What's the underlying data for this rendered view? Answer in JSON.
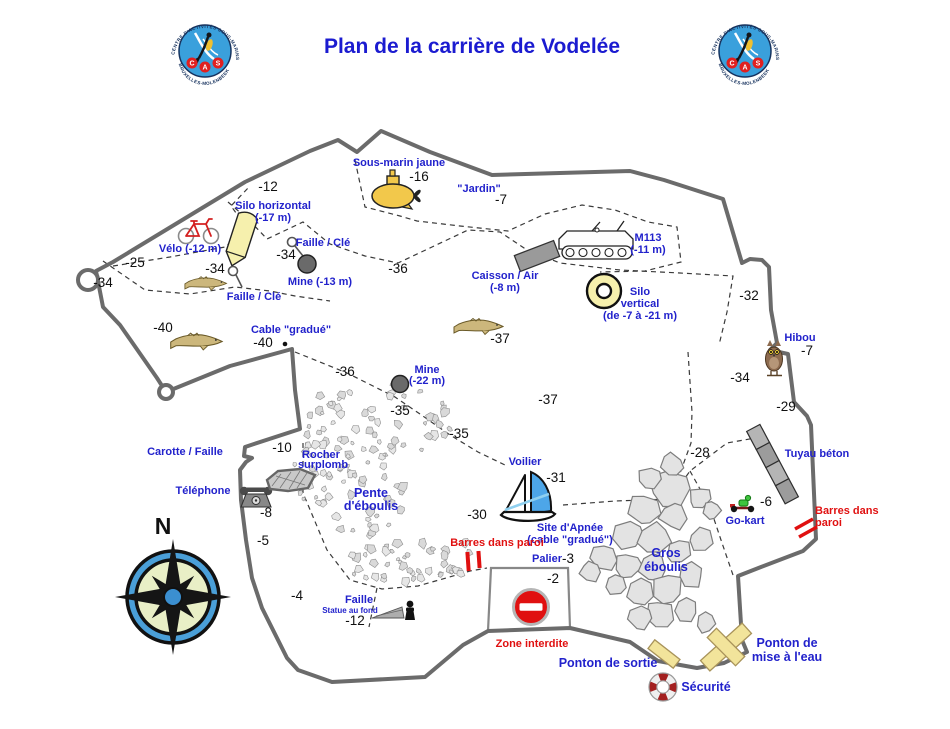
{
  "title": "Plan de la carrière de Vodelée",
  "logo": {
    "arc_top": "CENTRE D'ACTIVITÉS SOUS-MARINS",
    "arc_bottom": "BRUXELLES-MOLENBEEK",
    "letters": [
      "C",
      "A",
      "S"
    ]
  },
  "compass": {
    "north": "N"
  },
  "colors": {
    "title_blue": "#1b1bd0",
    "label_blue": "#2222cc",
    "warning_red": "#e01010",
    "boundary_gray": "#6b6b6b",
    "silo_yellow": "#f6f0ad",
    "submarine_yellow": "#f2c84b",
    "pontoon_yellow": "#f2e49b",
    "compass_blue": "#4a9fd8",
    "compass_inner": "#e9efc6"
  },
  "features": {
    "sous_marin": {
      "label": "Sous-marin jaune",
      "depth": "-16"
    },
    "jardin": {
      "label": "\"Jardin\"",
      "depth": "-7"
    },
    "silo_horizontal": {
      "label": "Silo horizontal",
      "sub": "(-17 m)"
    },
    "velo": {
      "label": "Vélo (-12 m)"
    },
    "faille_cle_a": {
      "label": "Faille / Clé"
    },
    "faille_cle_b": {
      "label": "Faille / Clé"
    },
    "mine_13": {
      "label": "Mine (-13 m)"
    },
    "m113": {
      "label": "M113",
      "sub": "(-11 m)"
    },
    "caisson": {
      "label": "Caisson / Air",
      "sub": "(-8 m)"
    },
    "silo_vertical": {
      "label": "Silo",
      "sub": "vertical",
      "sub2": "(de -7 à -21 m)"
    },
    "hibou": {
      "label": "Hibou",
      "depth": "-7"
    },
    "tuyau_beton": {
      "label": "Tuyau béton"
    },
    "cable_gradue": {
      "label": "Cable \"gradué\"",
      "depth": "-40"
    },
    "mine_22": {
      "label": "Mine",
      "sub": "(-22 m)"
    },
    "carotte_faille": {
      "label": "Carotte / Faille"
    },
    "telephone": {
      "label": "Téléphone",
      "depth": "-8"
    },
    "rocher_surplomb": {
      "label": "Rocher",
      "sub": "surplomb"
    },
    "pente_eboulis": {
      "label": "Pente",
      "sub": "d'éboulis"
    },
    "voilier": {
      "label": "Voilier",
      "depth": "-31",
      "depth2": "-30"
    },
    "site_apnee": {
      "label": "Site d'Apnée",
      "sub": "(cable \"gradué\")"
    },
    "barres_paroi_sud": {
      "label": "Barres dans paroi"
    },
    "palier": {
      "label": "Palier",
      "depth": "-3",
      "depth2": "-2"
    },
    "zone_interdite": {
      "label": "Zone interdite"
    },
    "gros_eboulis": {
      "label": "Gros",
      "sub": "éboulis"
    },
    "go_kart": {
      "label": "Go-kart",
      "depth": "-6"
    },
    "barres_paroi_est": {
      "label": "Barres dans",
      "sub": "paroi"
    },
    "faille_statue": {
      "label": "Faille",
      "sub": "Statue au fond",
      "depth": "-12"
    },
    "ponton_sortie": {
      "label": "Ponton de sortie"
    },
    "securite": {
      "label": "Sécurité"
    },
    "ponton_mise_eau": {
      "label": "Ponton de",
      "sub": "mise à l'eau"
    }
  },
  "depth_markers": {
    "m12": "-12",
    "m25": "-25",
    "m34_ouest": "-34",
    "m34_poisson": "-34",
    "m34_mine": "-34",
    "m36_nord": "-36",
    "m36_centre": "-36",
    "m40_ouest": "-40",
    "m37_poisson": "-37",
    "m37_centre": "-37",
    "m35_a": "-35",
    "m35_b": "-35",
    "m32": "-32",
    "m34_est": "-34",
    "m29": "-29",
    "m28": "-28",
    "m10": "-10",
    "m5": "-5",
    "m4": "-4"
  }
}
